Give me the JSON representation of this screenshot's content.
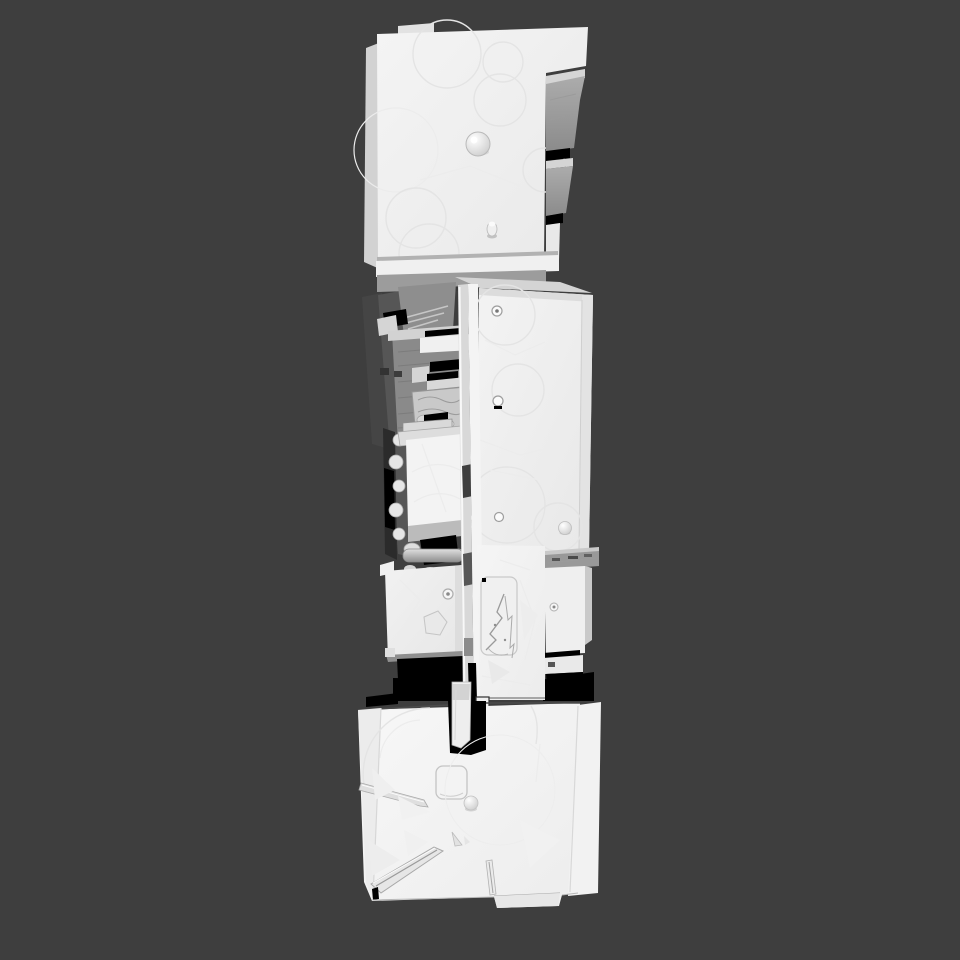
{
  "scene": {
    "view": "top-down-orthographic",
    "background_color": "#3E3E3E",
    "model": {
      "id": "scanned-mesh-assembly",
      "surface_color": "#F2F2F2",
      "side_face_color": "#999999",
      "shadow_color": "#000000",
      "parts": [
        {
          "id": "top-slab"
        },
        {
          "id": "mid-assembly"
        },
        {
          "id": "base-slab"
        }
      ]
    }
  }
}
